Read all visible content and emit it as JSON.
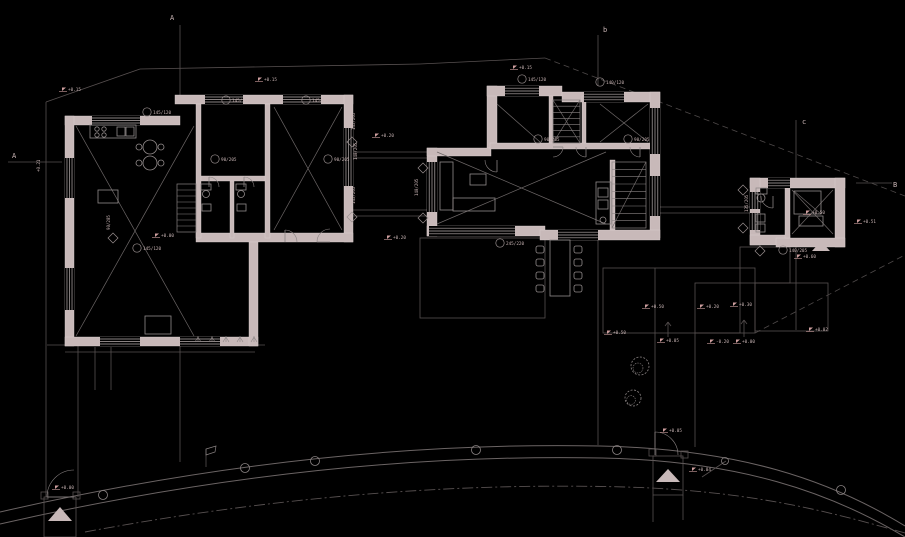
{
  "meta": {
    "title": "Ground floor site plan CAD drawing"
  },
  "palette": {
    "background": "#000000",
    "wall": "#c8b9b9",
    "wall_edge": "#dccfcf",
    "line": "#8a8383",
    "faint": "#575050",
    "site": "#4e4949",
    "road": "#6b6464",
    "cross": "#6e6868",
    "furniture": "#928b8b",
    "window": "#b7aeae",
    "accent": "#cf9f9f",
    "text": "#c8b4b4",
    "tag": "#9a9090"
  },
  "drawing": {
    "section_labels": [
      [
        170,
        20,
        "A"
      ],
      [
        12,
        158,
        "A"
      ],
      [
        603,
        32,
        "b"
      ],
      [
        802,
        124,
        "c"
      ],
      [
        893,
        187,
        "B"
      ]
    ],
    "flags": [
      [
        62,
        90,
        "+0.15"
      ],
      [
        258,
        80,
        "+0.15"
      ],
      [
        513,
        68,
        "+0.15"
      ],
      [
        375,
        136,
        "+0.20"
      ],
      [
        387,
        238,
        "+0.20"
      ],
      [
        607,
        333,
        "+0.50"
      ],
      [
        645,
        307,
        "+0.50"
      ],
      [
        700,
        307,
        "+0.20"
      ],
      [
        733,
        305,
        "+0.30"
      ],
      [
        660,
        341,
        "+0.05"
      ],
      [
        710,
        342,
        "-0.20"
      ],
      [
        736,
        342,
        "+0.00"
      ],
      [
        857,
        222,
        "+0.51"
      ],
      [
        797,
        257,
        "+0.60"
      ],
      [
        809,
        330,
        "+0.02"
      ],
      [
        692,
        470,
        "+0.04"
      ],
      [
        663,
        431,
        "+0.05"
      ],
      [
        55,
        488,
        "+0.00"
      ],
      [
        155,
        236,
        "+0.00"
      ],
      [
        806,
        213,
        "+0.50"
      ]
    ],
    "tags": [
      [
        147,
        112,
        "145/120"
      ],
      [
        226,
        100,
        "145/120"
      ],
      [
        306,
        100,
        "145/120"
      ],
      [
        137,
        248,
        "145/120"
      ],
      [
        522,
        79,
        "145/120"
      ],
      [
        600,
        82,
        "140/120"
      ],
      [
        500,
        243,
        "245/220"
      ],
      [
        783,
        250,
        "140/205"
      ],
      [
        215,
        159,
        "90/205"
      ],
      [
        328,
        159,
        "90/205"
      ],
      [
        538,
        139,
        "90/205"
      ],
      [
        628,
        139,
        "90/205"
      ]
    ],
    "rot_labels": [
      [
        357,
        160,
        "140/205"
      ],
      [
        418,
        196,
        "140/205"
      ],
      [
        748,
        212,
        "135/205"
      ],
      [
        110,
        230,
        "90/205"
      ],
      [
        355,
        130,
        "145/205"
      ],
      [
        355,
        204,
        "145/205"
      ],
      [
        40,
        172,
        "+0.21"
      ]
    ],
    "diamonds": [
      [
        352,
        142
      ],
      [
        352,
        217
      ],
      [
        423,
        168
      ],
      [
        423,
        218
      ],
      [
        743,
        190
      ],
      [
        743,
        228
      ],
      [
        113,
        238
      ],
      [
        760,
        251
      ]
    ],
    "walls": [
      [
        175,
        95,
        178,
        9
      ],
      [
        344,
        95,
        9,
        147
      ],
      [
        196,
        233,
        157,
        9
      ],
      [
        65,
        116,
        115,
        9
      ],
      [
        65,
        116,
        9,
        230
      ],
      [
        65,
        337,
        193,
        9
      ],
      [
        249,
        242,
        9,
        104
      ],
      [
        196,
        104,
        5,
        134
      ],
      [
        265,
        104,
        5,
        134
      ],
      [
        201,
        176,
        64,
        5
      ],
      [
        230,
        181,
        4,
        57
      ],
      [
        487,
        86,
        10,
        62
      ],
      [
        487,
        86,
        75,
        10
      ],
      [
        562,
        92,
        98,
        10
      ],
      [
        650,
        92,
        10,
        146
      ],
      [
        427,
        148,
        10,
        88
      ],
      [
        427,
        148,
        64,
        8
      ],
      [
        427,
        226,
        118,
        10
      ],
      [
        540,
        230,
        120,
        10
      ],
      [
        549,
        96,
        4,
        52
      ],
      [
        582,
        96,
        4,
        52
      ],
      [
        490,
        143,
        165,
        6
      ],
      [
        610,
        160,
        5,
        70
      ],
      [
        750,
        178,
        95,
        10
      ],
      [
        835,
        178,
        10,
        69
      ],
      [
        750,
        178,
        10,
        67
      ],
      [
        750,
        235,
        40,
        10
      ],
      [
        776,
        238,
        69,
        9
      ],
      [
        785,
        188,
        5,
        50
      ]
    ],
    "windows": [
      [
        205,
        95,
        38,
        9
      ],
      [
        283,
        95,
        38,
        9
      ],
      [
        92,
        116,
        48,
        9
      ],
      [
        65,
        158,
        9,
        40
      ],
      [
        65,
        268,
        9,
        42
      ],
      [
        100,
        337,
        40,
        9
      ],
      [
        180,
        337,
        40,
        9
      ],
      [
        344,
        128,
        9,
        58
      ],
      [
        505,
        86,
        34,
        10
      ],
      [
        584,
        92,
        40,
        10
      ],
      [
        650,
        108,
        10,
        46
      ],
      [
        650,
        176,
        10,
        40
      ],
      [
        427,
        162,
        10,
        50
      ],
      [
        429,
        226,
        86,
        10
      ],
      [
        558,
        230,
        40,
        10
      ],
      [
        750,
        192,
        10,
        17
      ],
      [
        750,
        213,
        10,
        17
      ],
      [
        768,
        178,
        22,
        10
      ]
    ],
    "crosses": [
      [
        76,
        126,
        194,
        336
      ],
      [
        274,
        107,
        342,
        230
      ],
      [
        437,
        152,
        606,
        224
      ],
      [
        600,
        104,
        648,
        142
      ],
      [
        792,
        190,
        833,
        234
      ],
      [
        553,
        100,
        580,
        143
      ]
    ],
    "single_diagonals": [
      [
        497,
        104,
        540,
        142
      ],
      [
        612,
        228,
        646,
        162
      ],
      [
        794,
        191,
        821,
        214
      ]
    ],
    "stairs": [
      [
        177,
        184,
        19,
        48,
        8
      ],
      [
        612,
        162,
        34,
        66,
        9
      ],
      [
        553,
        100,
        27,
        43,
        7
      ]
    ],
    "lines": [
      [
        46,
        102,
        140,
        69
      ],
      [
        140,
        69,
        420,
        64
      ],
      [
        420,
        64,
        545,
        58
      ],
      [
        46,
        102,
        46,
        497
      ],
      [
        78,
        340,
        78,
        497
      ],
      [
        47,
        345,
        265,
        345
      ],
      [
        65,
        352,
        255,
        352
      ],
      [
        95,
        347,
        95,
        390
      ],
      [
        111,
        347,
        111,
        390
      ],
      [
        180,
        25,
        180,
        95
      ],
      [
        180,
        346,
        180,
        462
      ],
      [
        598,
        35,
        598,
        86
      ],
      [
        598,
        240,
        598,
        445
      ],
      [
        796,
        120,
        796,
        178
      ],
      [
        796,
        247,
        796,
        330
      ],
      [
        8,
        162,
        62,
        162
      ],
      [
        856,
        183,
        892,
        183
      ],
      [
        353,
        152,
        427,
        152
      ],
      [
        353,
        158,
        427,
        158
      ],
      [
        353,
        210,
        427,
        210
      ],
      [
        353,
        216,
        427,
        216
      ],
      [
        660,
        207,
        750,
        207
      ],
      [
        660,
        213,
        750,
        213
      ],
      [
        655,
        268,
        655,
        333
      ],
      [
        655,
        333,
        655,
        447
      ],
      [
        695,
        333,
        695,
        447
      ],
      [
        653,
        495,
        653,
        522
      ],
      [
        683,
        495,
        683,
        520
      ],
      [
        668,
        322,
        668,
        337
      ],
      [
        665,
        326,
        668,
        322
      ],
      [
        671,
        326,
        668,
        322
      ],
      [
        744,
        320,
        744,
        337
      ],
      [
        741,
        324,
        744,
        320
      ],
      [
        747,
        324,
        744,
        320
      ],
      [
        206,
        449,
        206,
        467
      ],
      [
        702,
        477,
        726,
        461
      ]
    ],
    "dashed_lines": [
      [
        545,
        58,
        905,
        196
      ],
      [
        755,
        333,
        903,
        256
      ]
    ],
    "thin_rects": [
      [
        603,
        268,
        152,
        65
      ],
      [
        755,
        283,
        73,
        48
      ],
      [
        695,
        283,
        45,
        50
      ],
      [
        740,
        247,
        50,
        36
      ],
      [
        420,
        238,
        125,
        80
      ],
      [
        44,
        497,
        32,
        40
      ],
      [
        653,
        456,
        30,
        39
      ],
      [
        41,
        492,
        7,
        7
      ],
      [
        73,
        492,
        7,
        7
      ],
      [
        649,
        449,
        7,
        7
      ],
      [
        681,
        451,
        7,
        7
      ]
    ],
    "roads": [
      "M 0,512 C 250,455 450,443 600,446 C 740,449 830,480 905,526",
      "M 0,524 C 250,467 450,455 602,458 C 740,461 830,492 905,537"
    ],
    "road_dashdot": "M 85,532 C 300,492 480,483 625,487 C 760,491 840,515 905,533",
    "survey_circles": [
      [
        103,
        495,
        4.5
      ],
      [
        245,
        468,
        4.5
      ],
      [
        315,
        461,
        4.5
      ],
      [
        476,
        450,
        4.5
      ],
      [
        617,
        450,
        4.5
      ],
      [
        841,
        490,
        4.5
      ],
      [
        725,
        461,
        3.5
      ]
    ],
    "arcs": [
      [
        209,
        187,
        10,
        -90,
        0
      ],
      [
        244,
        187,
        10,
        -90,
        0
      ],
      [
        330,
        242,
        13,
        180,
        270
      ],
      [
        285,
        242,
        12,
        270,
        360
      ],
      [
        497,
        160,
        12,
        90,
        180
      ],
      [
        553,
        147,
        10,
        0,
        90
      ],
      [
        586,
        147,
        10,
        90,
        180
      ],
      [
        640,
        147,
        10,
        90,
        180
      ],
      [
        773,
        196,
        12,
        90,
        180
      ],
      [
        74,
        497,
        27,
        180,
        270
      ],
      [
        655,
        455,
        23,
        -90,
        0
      ]
    ],
    "furn_rects": [
      [
        90,
        125,
        46,
        13
      ],
      [
        117,
        127,
        8,
        9
      ],
      [
        126,
        127,
        8,
        9
      ],
      [
        98,
        190,
        20,
        13
      ],
      [
        145,
        316,
        26,
        18
      ],
      [
        201,
        184,
        10,
        6
      ],
      [
        236,
        184,
        10,
        6
      ],
      [
        202,
        204,
        9,
        7
      ],
      [
        237,
        204,
        9,
        7
      ],
      [
        440,
        162,
        13,
        48
      ],
      [
        453,
        198,
        42,
        13
      ],
      [
        470,
        174,
        16,
        11
      ],
      [
        550,
        240,
        20,
        56
      ],
      [
        596,
        182,
        15,
        42
      ],
      [
        598,
        188,
        10,
        9
      ],
      [
        598,
        200,
        10,
        9
      ],
      [
        756,
        188,
        11,
        6
      ],
      [
        756,
        214,
        9,
        8
      ],
      [
        756,
        224,
        9,
        8
      ],
      [
        794,
        191,
        27,
        23
      ],
      [
        799,
        216,
        24,
        10
      ]
    ],
    "furn_circles": [
      [
        97,
        129,
        2.2
      ],
      [
        104,
        129,
        2.2
      ],
      [
        97,
        135,
        2.2
      ],
      [
        104,
        135,
        2.2
      ],
      [
        150,
        147,
        7
      ],
      [
        150,
        163,
        7
      ],
      [
        139,
        147,
        3
      ],
      [
        161,
        147,
        3
      ],
      [
        139,
        163,
        3
      ],
      [
        161,
        163,
        3
      ],
      [
        206,
        194,
        3.5
      ],
      [
        241,
        194,
        3.5
      ],
      [
        761,
        198,
        4
      ],
      [
        603,
        220,
        3
      ]
    ],
    "chairs": [
      [
        540,
        246
      ],
      [
        540,
        259
      ],
      [
        540,
        272
      ],
      [
        540,
        285
      ],
      [
        578,
        246
      ],
      [
        578,
        259
      ],
      [
        578,
        272
      ],
      [
        578,
        285
      ]
    ],
    "triangles": [
      [
        [
          60,
          507
        ],
        [
          48,
          521
        ],
        [
          72,
          521
        ]
      ],
      [
        [
          668,
          469
        ],
        [
          656,
          482
        ],
        [
          680,
          482
        ]
      ],
      [
        [
          821,
          241
        ],
        [
          812,
          251
        ],
        [
          830,
          251
        ]
      ]
    ],
    "sign_flag": [
      [
        206,
        449
      ],
      [
        216,
        446
      ],
      [
        215,
        452
      ],
      [
        206,
        455
      ]
    ],
    "bushes": [
      [
        640,
        366,
        9
      ],
      [
        633,
        398,
        8
      ]
    ],
    "tufts": [
      [
        198,
        342
      ],
      [
        212,
        342
      ],
      [
        226,
        342
      ],
      [
        240,
        342
      ],
      [
        254,
        342
      ]
    ]
  }
}
